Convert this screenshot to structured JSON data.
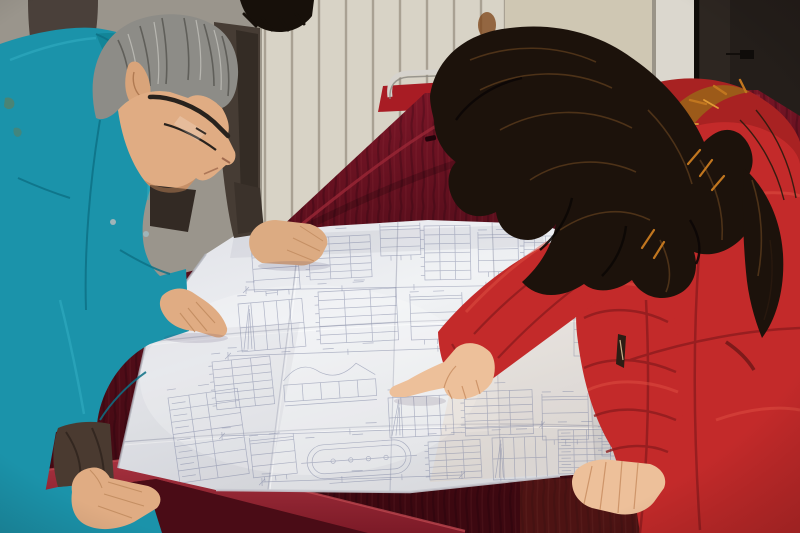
{
  "scene": {
    "type": "photograph",
    "description": "Two workers lean over a large folded engineering blueprint spread on a dark red velvet table; a gray-haired man in a teal work jacket studies it while a woman in a red fur-hooded parka points at a detail; a third person in dark clothes stands behind.",
    "palette": {
      "left_wall": "#9a958c",
      "radiator": "#d8d3c6",
      "radiator_shadow": "#a9a193",
      "right_wall": "#cfc7b3",
      "stain": "#7c4214",
      "door_frame": "#dbd7ce",
      "door": "#241e1a",
      "chair_frame": "#d6d3cd",
      "chair_seat": "#a81c24",
      "velvet": "#5d0f1d",
      "velvet_dark": "#430a14",
      "velvet_edge": "#932331",
      "drape": "#4a0c16",
      "paper": "#e9eaef",
      "paper_line": "#7d84a2",
      "crease": "#b9bcc8",
      "teal_jacket": "#1b93aa",
      "teal_dark": "#0e7186",
      "teal_light": "#35b1c6",
      "man_hair": "#8d8c87",
      "man_skin": "#e0ac83",
      "cuff": "#4a3a30",
      "bg_person_jacket": "#463c34",
      "bg_person_hair": "#17100a",
      "coat": "#c32a2a",
      "coat_dark": "#8e1c1e",
      "coat_light": "#df4f42",
      "woman_hair": "#1c120b",
      "woman_hair_light": "#5a3a1c",
      "fur": "#c1761f",
      "fur_dark": "#6e4512",
      "woman_skin": "#edc09a"
    }
  },
  "blueprint": {
    "line_color": "#7d84a2",
    "clusters": [
      {
        "type": "detail",
        "x": 252,
        "y": 258,
        "w": 46,
        "h": 34,
        "rot": -4
      },
      {
        "type": "stack",
        "x": 308,
        "y": 238,
        "w": 62,
        "h": 42,
        "rot": -3
      },
      {
        "type": "detail",
        "x": 380,
        "y": 230,
        "w": 40,
        "h": 26,
        "rot": -2
      },
      {
        "type": "stack",
        "x": 424,
        "y": 226,
        "w": 46,
        "h": 54,
        "rot": -1
      },
      {
        "type": "detail",
        "x": 478,
        "y": 238,
        "w": 40,
        "h": 34,
        "rot": -1
      },
      {
        "type": "stack",
        "x": 524,
        "y": 236,
        "w": 32,
        "h": 40,
        "rot": 0
      },
      {
        "type": "plan",
        "x": 238,
        "y": 304,
        "w": 64,
        "h": 48,
        "rot": -5
      },
      {
        "type": "stack",
        "x": 318,
        "y": 292,
        "w": 78,
        "h": 52,
        "rot": -3
      },
      {
        "type": "detail",
        "x": 410,
        "y": 300,
        "w": 52,
        "h": 40,
        "rot": -2
      },
      {
        "type": "stack",
        "x": 466,
        "y": 310,
        "w": 56,
        "h": 44,
        "rot": -1
      },
      {
        "type": "detail",
        "x": 574,
        "y": 316,
        "w": 42,
        "h": 40,
        "rot": 0
      },
      {
        "type": "stack",
        "x": 212,
        "y": 362,
        "w": 58,
        "h": 48,
        "rot": -6
      },
      {
        "type": "wave",
        "x": 282,
        "y": 360,
        "w": 92,
        "h": 42,
        "rot": -4
      },
      {
        "type": "plan",
        "x": 388,
        "y": 398,
        "w": 64,
        "h": 40,
        "rot": -3
      },
      {
        "type": "stack",
        "x": 464,
        "y": 392,
        "w": 68,
        "h": 44,
        "rot": -2
      },
      {
        "type": "detail",
        "x": 542,
        "y": 400,
        "w": 46,
        "h": 40,
        "rot": -1
      },
      {
        "type": "table",
        "x": 168,
        "y": 398,
        "w": 70,
        "h": 86,
        "rot": -8
      },
      {
        "type": "detail",
        "x": 250,
        "y": 444,
        "w": 44,
        "h": 34,
        "rot": -6
      },
      {
        "type": "oval",
        "x": 306,
        "y": 446,
        "w": 104,
        "h": 34,
        "rot": -4
      },
      {
        "type": "stack",
        "x": 428,
        "y": 442,
        "w": 52,
        "h": 38,
        "rot": -3
      },
      {
        "type": "plan",
        "x": 492,
        "y": 438,
        "w": 54,
        "h": 42,
        "rot": -2
      },
      {
        "type": "table",
        "x": 558,
        "y": 430,
        "w": 52,
        "h": 44,
        "rot": -1
      },
      {
        "type": "stack",
        "x": 602,
        "y": 386,
        "w": 26,
        "h": 70,
        "rot": 0
      },
      {
        "type": "table",
        "x": 602,
        "y": 300,
        "w": 24,
        "h": 60,
        "rot": 1
      },
      {
        "type": "dim",
        "x": 246,
        "y": 290,
        "w": 240,
        "h": 0,
        "rot": -1
      },
      {
        "type": "dim",
        "x": 228,
        "y": 356,
        "w": 300,
        "h": 0,
        "rot": -2
      },
      {
        "type": "dim",
        "x": 222,
        "y": 436,
        "w": 320,
        "h": 0,
        "rot": -2
      },
      {
        "type": "dim",
        "x": 262,
        "y": 482,
        "w": 200,
        "h": 0,
        "rot": -2
      }
    ]
  }
}
